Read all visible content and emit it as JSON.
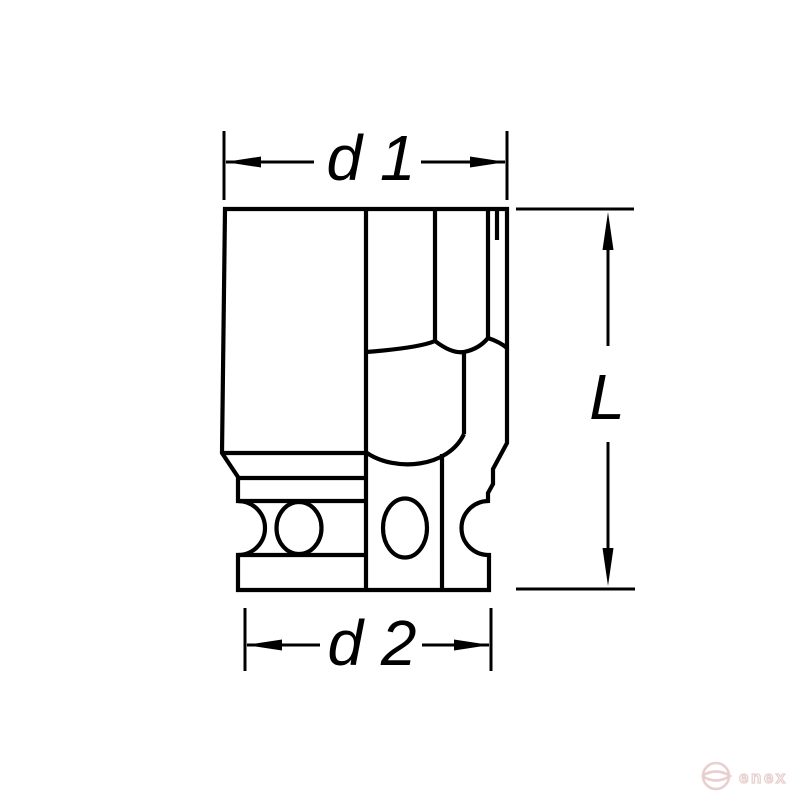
{
  "diagram": {
    "type": "technical-drawing",
    "subject": "impact-socket",
    "labels": {
      "d1": "d 1",
      "d2": "d 2",
      "length": "L"
    },
    "dimensions": [
      {
        "label": "d 1",
        "position": "top",
        "orientation": "horizontal"
      },
      {
        "label": "d 2",
        "position": "bottom",
        "orientation": "horizontal"
      },
      {
        "label": "L",
        "position": "right",
        "orientation": "vertical"
      }
    ]
  },
  "watermark": {
    "text": "enex",
    "icon": "enex-circle-logo"
  },
  "colors": {
    "background": "#ffffff",
    "line": "#000000",
    "watermark": "#e9d0d0"
  }
}
